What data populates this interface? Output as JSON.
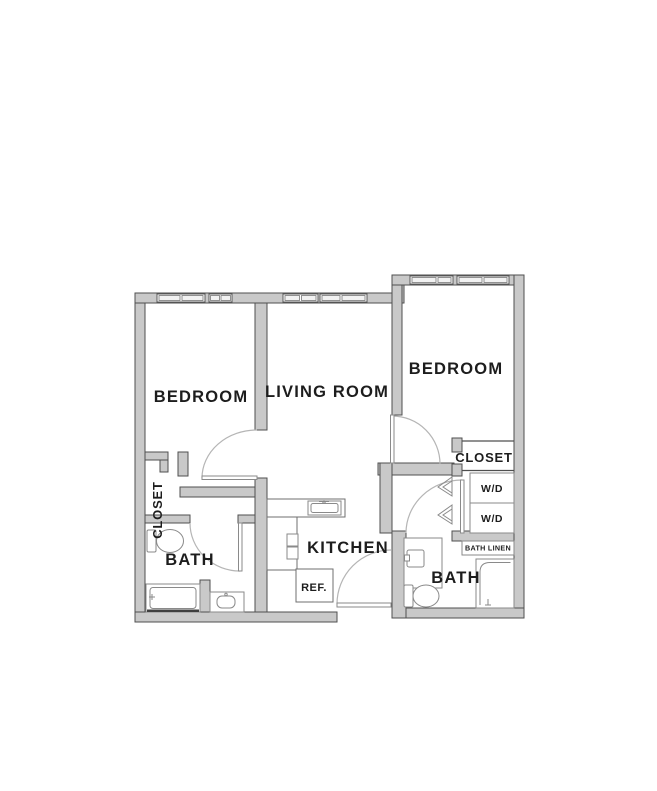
{
  "title": "apartment-floor-plan",
  "labels": {
    "bedroom_left": "BEDROOM",
    "living_room": "LIVING ROOM",
    "bedroom_right": "BEDROOM",
    "closet_left": "CLOSET",
    "closet_right": "CLOSET",
    "bath_left": "BATH",
    "kitchen": "KITCHEN",
    "ref": "REF.",
    "wd_upper": "W/D",
    "wd_lower": "W/D",
    "bath_linen": "BATH LINEN",
    "bath_right": "BATH"
  },
  "colors": {
    "background": "#ffffff",
    "wall_fill": "#c9c9c9",
    "wall_stroke": "#4f4f4f",
    "fixture_stroke": "#8a8a8a",
    "door_arc": "#b5b5b5",
    "text": "#1d1d1d"
  },
  "fixtures": [
    "toilet-left-bath",
    "bathtub",
    "vanity-sink-left-bath",
    "kitchen-sink",
    "range",
    "refrigerator",
    "washer-dryer-upper",
    "washer-dryer-lower",
    "linen-shelf",
    "vanity-sink-right-bath",
    "toilet-right-bath",
    "shower"
  ]
}
